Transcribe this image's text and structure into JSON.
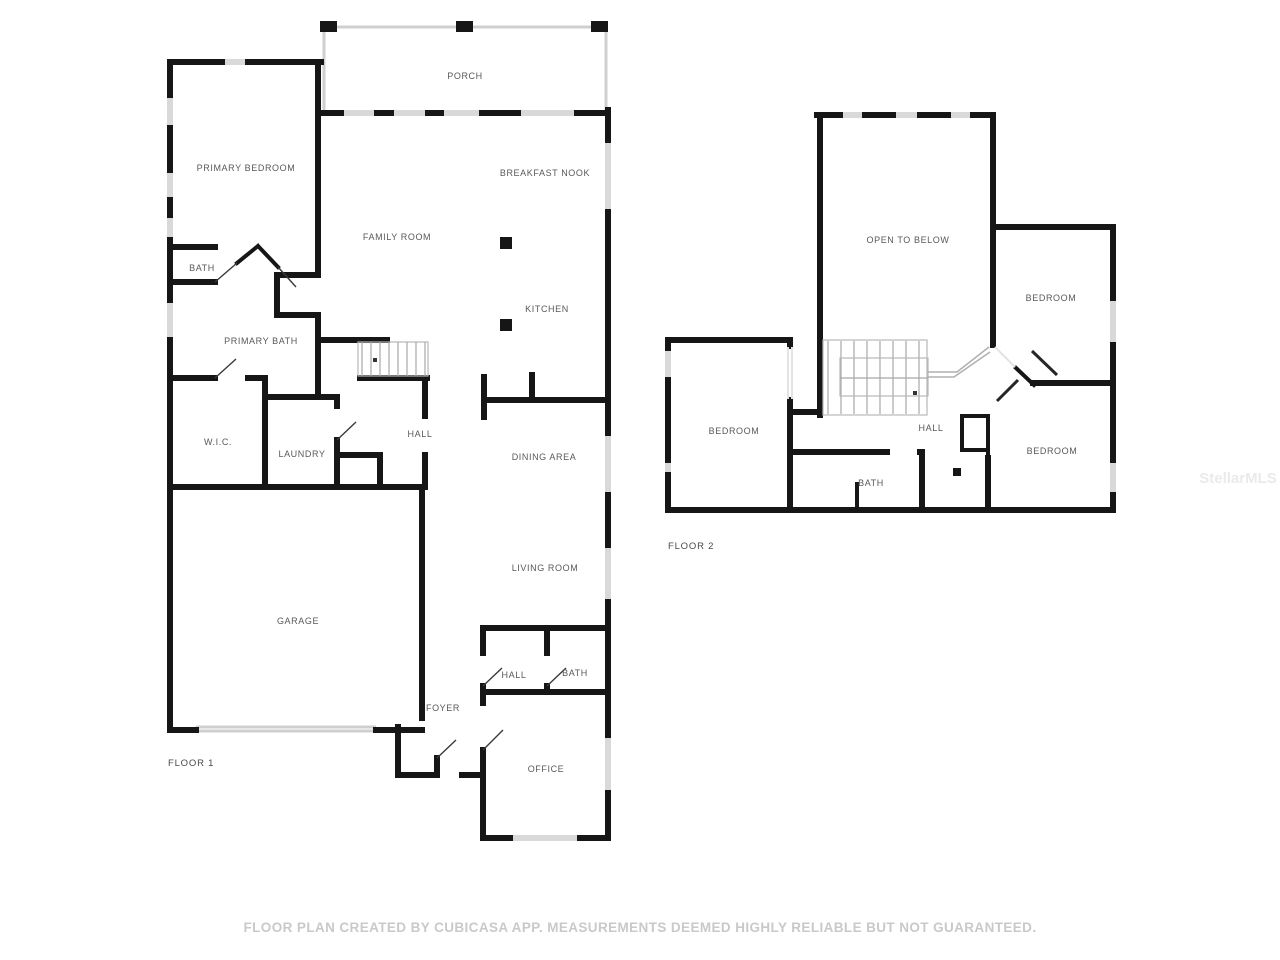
{
  "colors": {
    "wall": "#161616",
    "window": "#d9d9d9",
    "label": "#595959",
    "floor_label": "#4a4a4a",
    "disclaimer": "#c9c9c9",
    "watermark": "#eaeaea",
    "background": "#ffffff"
  },
  "floor1": {
    "label": "FLOOR 1",
    "rooms": [
      {
        "name": "PORCH"
      },
      {
        "name": "PRIMARY BEDROOM"
      },
      {
        "name": "BREAKFAST NOOK"
      },
      {
        "name": "FAMILY ROOM"
      },
      {
        "name": "BATH"
      },
      {
        "name": "KITCHEN"
      },
      {
        "name": "PRIMARY BATH"
      },
      {
        "name": "W.I.C."
      },
      {
        "name": "LAUNDRY"
      },
      {
        "name": "HALL"
      },
      {
        "name": "DINING AREA"
      },
      {
        "name": "LIVING ROOM"
      },
      {
        "name": "GARAGE"
      },
      {
        "name": "HALL"
      },
      {
        "name": "BATH"
      },
      {
        "name": "FOYER"
      },
      {
        "name": "OFFICE"
      }
    ]
  },
  "floor2": {
    "label": "FLOOR 2",
    "rooms": [
      {
        "name": "OPEN TO BELOW"
      },
      {
        "name": "BEDROOM"
      },
      {
        "name": "BEDROOM"
      },
      {
        "name": "HALL"
      },
      {
        "name": "BEDROOM"
      },
      {
        "name": "BATH"
      }
    ]
  },
  "footer": {
    "disclaimer": "FLOOR PLAN CREATED BY CUBICASA APP. MEASUREMENTS DEEMED HIGHLY RELIABLE BUT NOT GUARANTEED."
  },
  "watermark": {
    "text": "StellarMLS"
  }
}
